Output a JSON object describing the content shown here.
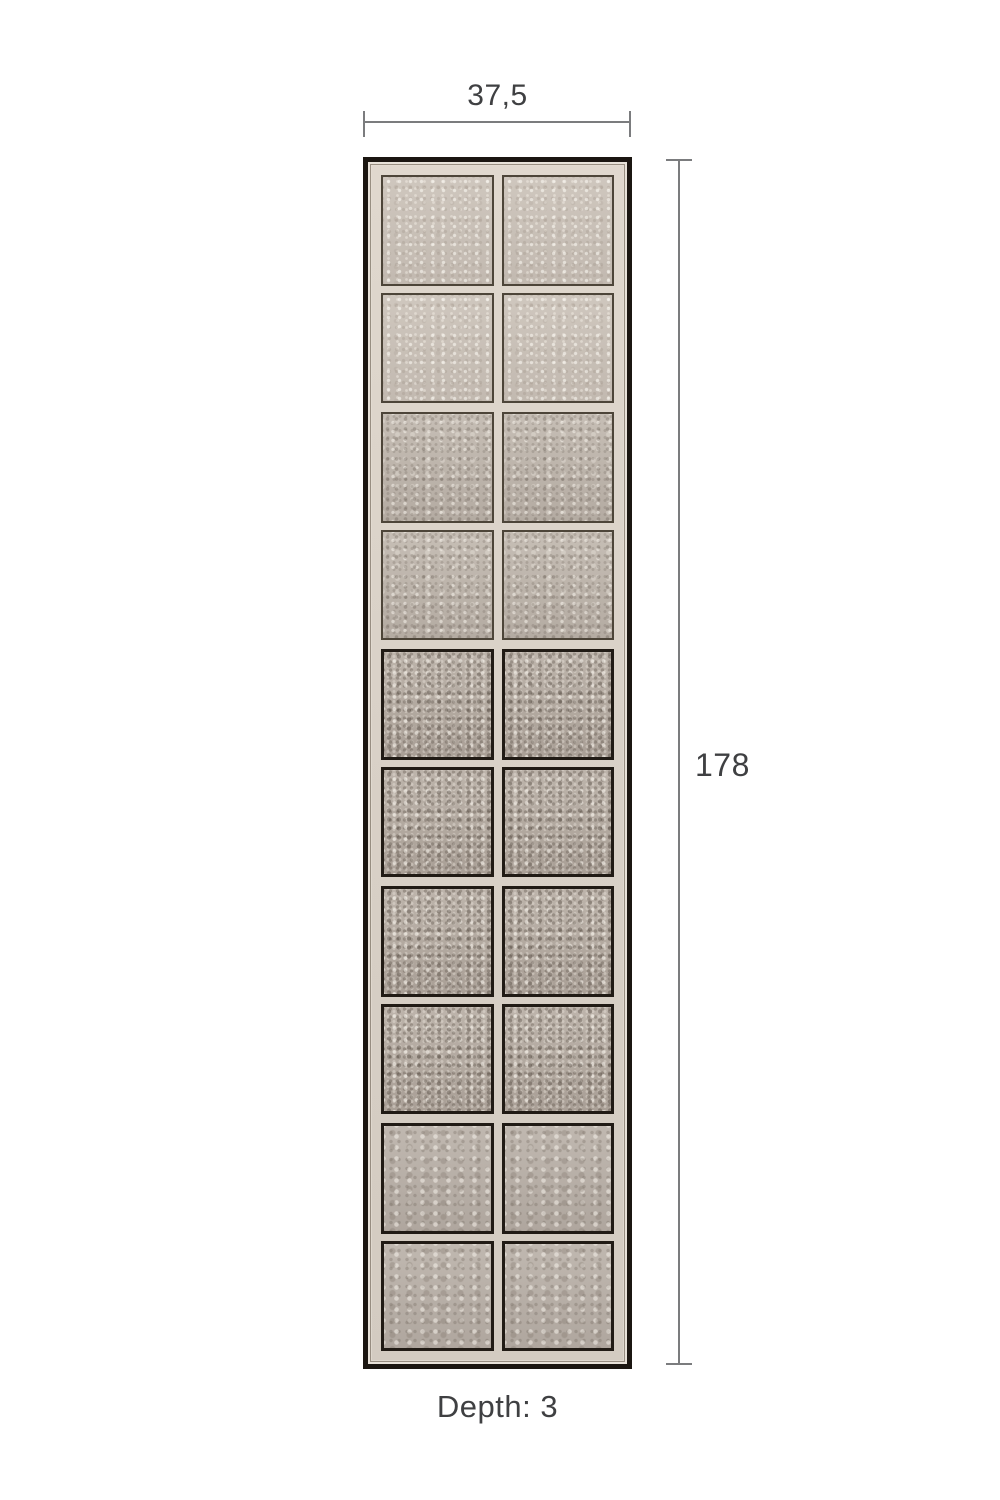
{
  "page": {
    "background": "#ffffff"
  },
  "colors": {
    "page_bg": "#ffffff",
    "dim_line": "#7b7c7e",
    "dim_text": "#3f4042",
    "frame_outer": "#1b1611",
    "frame_inner": "#d9d1c7",
    "pane_border_light": "#4d4539",
    "pane_border_dark": "#211b15"
  },
  "annotations": {
    "width_label": "37,5",
    "height_label": "178",
    "depth_label": "Depth: 3"
  },
  "panel": {
    "description": "antiqued-mirror panel, 2 columns x 10 rows of textured glass panes in 5 framed sections",
    "columns": 2,
    "sections": [
      {
        "rows": 2,
        "tone": "light"
      },
      {
        "rows": 2,
        "tone": "medium"
      },
      {
        "rows": 2,
        "tone": "coarse"
      },
      {
        "rows": 2,
        "tone": "coarse"
      },
      {
        "rows": 2,
        "tone": "soft"
      }
    ]
  }
}
